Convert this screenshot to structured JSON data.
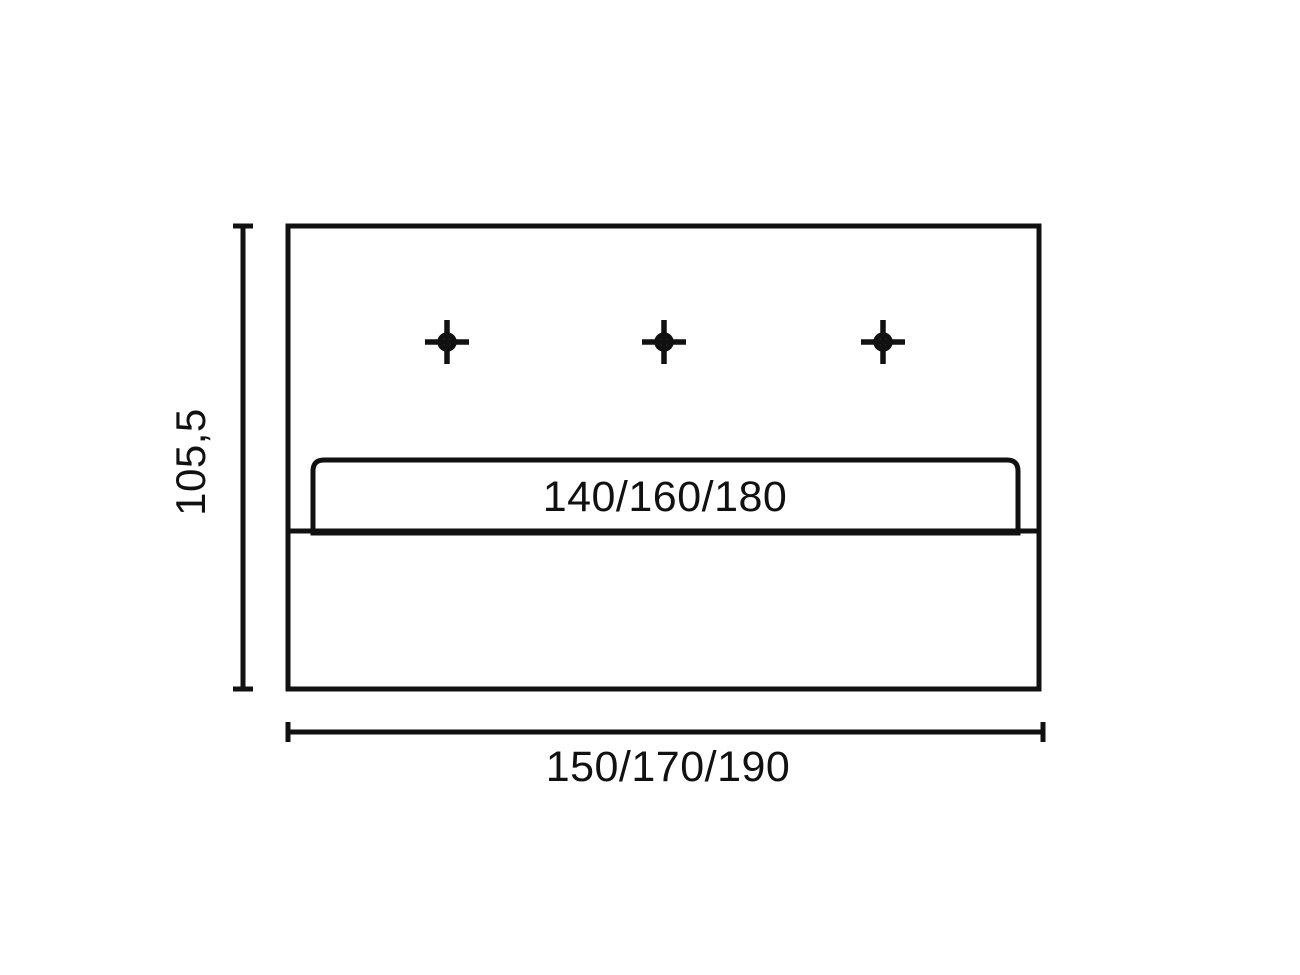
{
  "page": {
    "background": "#ffffff",
    "kind": "technical dimension drawing of upholstered panel with mounting holes"
  },
  "colors": {
    "panel_fill": "#b3b3b3",
    "line": "#111111",
    "slot_fill": "#ffffff"
  },
  "diagram": {
    "hole_markers": {
      "count": 3,
      "symbol": "crosshair"
    },
    "dimensions": {
      "height": {
        "label": "105,5"
      },
      "inner_width": {
        "label": "140/160/180"
      },
      "outer_width": {
        "label": "150/170/190"
      }
    }
  }
}
